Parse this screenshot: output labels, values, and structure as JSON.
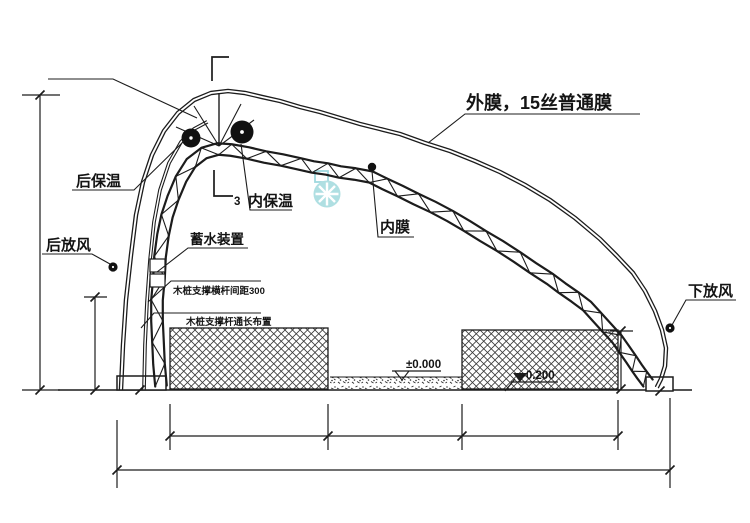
{
  "drawing": {
    "kind": "greenhouse-cross-section",
    "labels": {
      "outer_membrane": "外膜，15丝普通膜",
      "rear_insulation": "后保温",
      "inner_insulation": "内保温",
      "detail_number": "3",
      "inner_membrane": "内膜",
      "rear_vent": "后放风",
      "lower_vent": "下放风",
      "water_storage": "蓄水装置",
      "note_bar_spacing": "木桩支撑横杆间距300",
      "note_bar_length": "木桩支撑杆通长布置",
      "level_zero": "±0.000",
      "level_minus": "-0.200"
    },
    "colors": {
      "line": "#1c1c1c",
      "hatch": "#3a3a3a",
      "watermark": "#8fd2d9",
      "background": "#ffffff"
    }
  }
}
